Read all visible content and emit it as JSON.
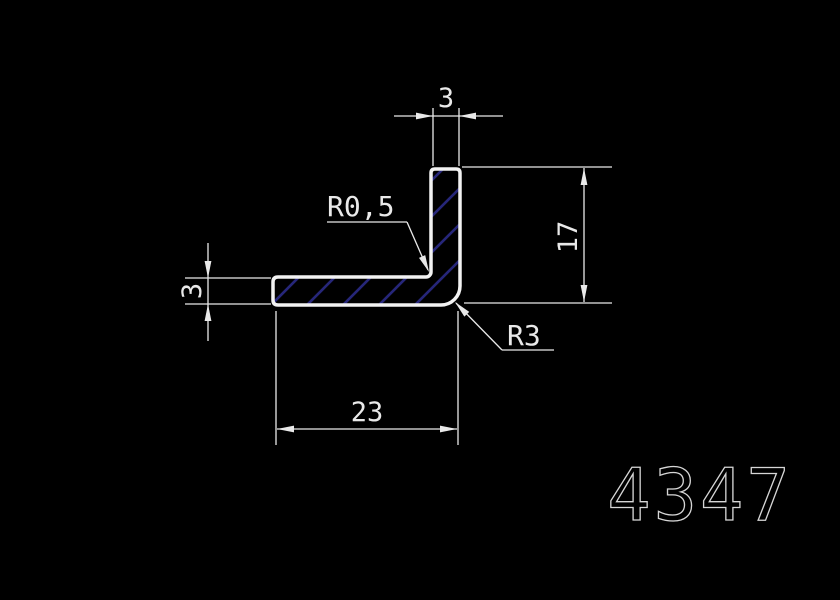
{
  "drawing": {
    "background_color": "#000000",
    "outline_color": "#f2f2f2",
    "dim_color": "#e9e9e9",
    "text_color": "#e9e9e9",
    "hatch_color": "#26267a",
    "title_color": "#d6d6d6",
    "part_number": "4347",
    "dimensions": {
      "top_width": "3",
      "left_thickness": "3",
      "right_height": "17",
      "bottom_width": "23"
    },
    "annotations": {
      "inner_fillet_radius": "R0,5",
      "outer_fillet_radius": "R3"
    }
  }
}
